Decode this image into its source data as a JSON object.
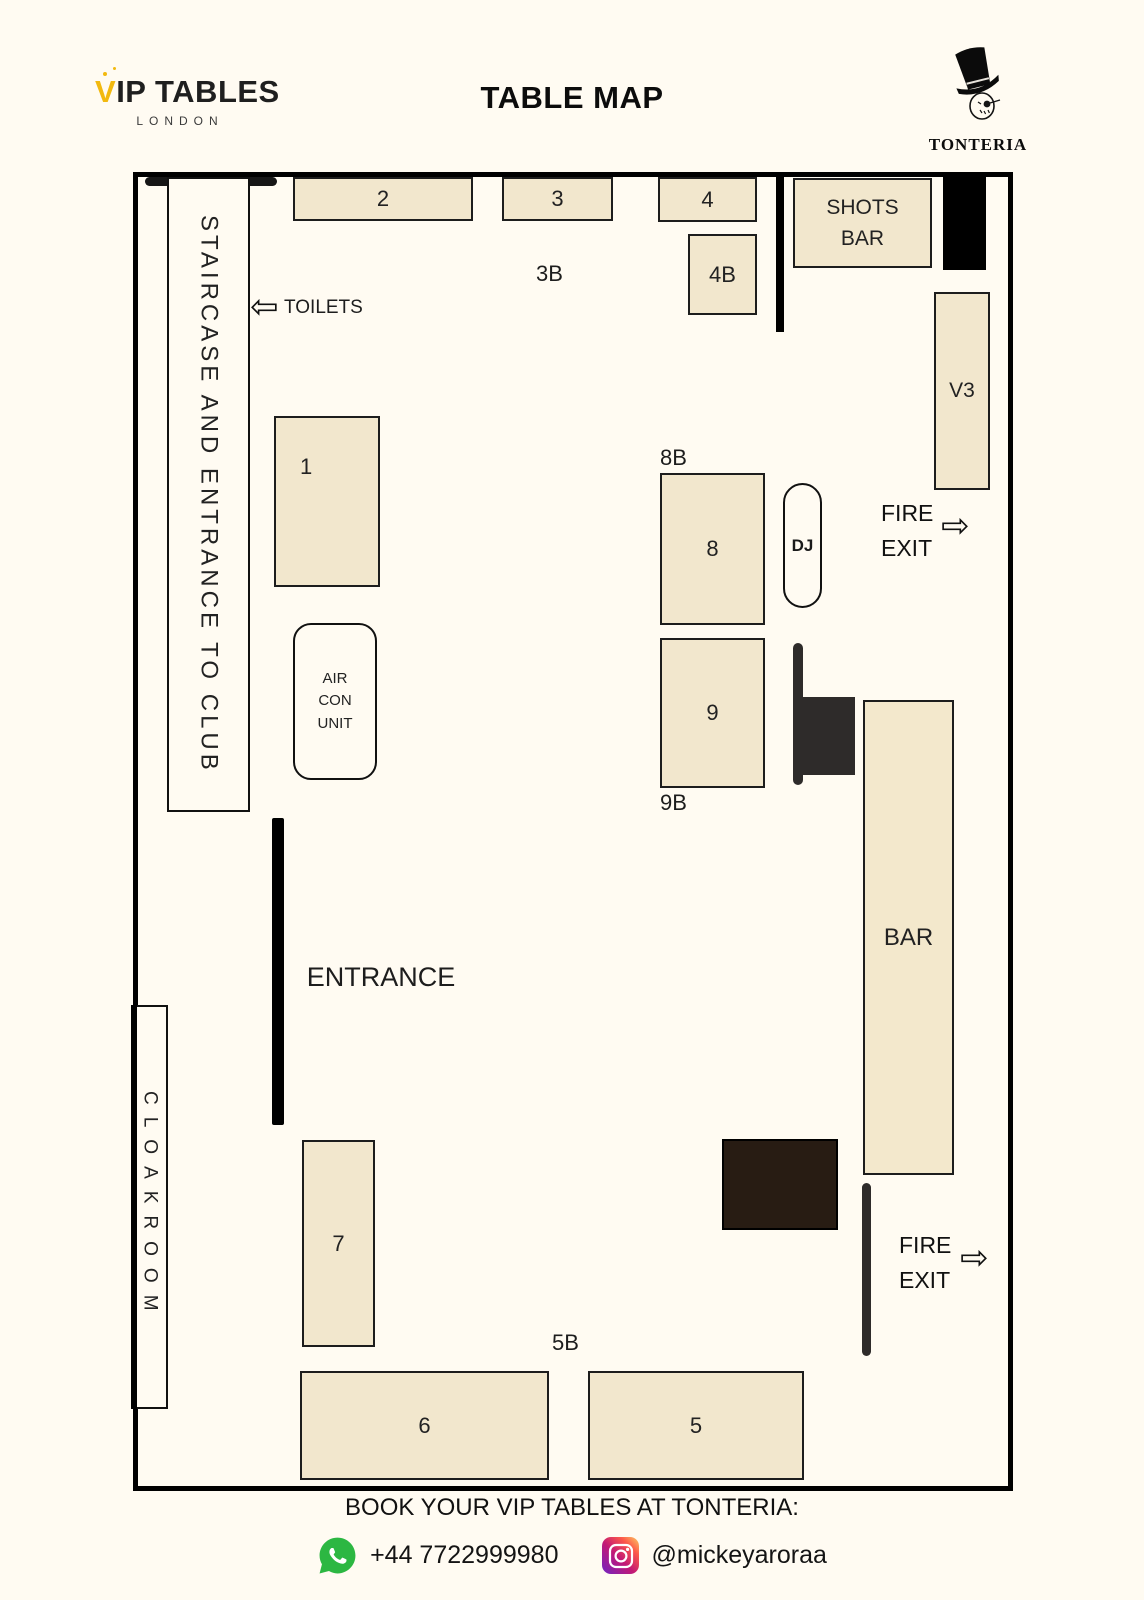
{
  "header": {
    "brand": {
      "name": "VIP TABLES",
      "city": "LONDON"
    },
    "title": "TABLE MAP",
    "venue": "TONTERIA"
  },
  "map": {
    "staircase_label": "STAIRCASE AND ENTRANCE TO CLUB",
    "toilets_label": "TOILETS",
    "entrance_label": "ENTRANCE",
    "cloakroom_label": "CLOAKROOM",
    "shots_bar": {
      "line1": "SHOTS",
      "line2": "BAR"
    },
    "bar_label": "BAR",
    "dj_label": "DJ",
    "aircon": {
      "line1": "AIR",
      "line2": "CON",
      "line3": "UNIT"
    },
    "fire_exit": {
      "line1": "FIRE",
      "line2": "EXIT"
    },
    "tables": {
      "t1": "1",
      "t2": "2",
      "t3": "3",
      "t4": "4",
      "t4b": "4B",
      "t5": "5",
      "t6": "6",
      "t7": "7",
      "t8": "8",
      "t9": "9",
      "v3": "V3"
    },
    "booths": {
      "b3": "3B",
      "b5": "5B",
      "b8": "8B",
      "b9": "9B"
    }
  },
  "icons": {
    "toilets_arrow": "⇦",
    "fire_exit_arrow": "⇨",
    "whatsapp": "whatsapp-icon",
    "instagram": "instagram-icon"
  },
  "footer": {
    "cta": "BOOK YOUR VIP TABLES AT TONTERIA:",
    "phone": "+44 7722999980",
    "instagram_handle": "@mickeyaroraa"
  },
  "colors": {
    "background": "#FFFBF2",
    "table_fill": "#F2E7CD",
    "outline": "#000000",
    "accent_yellow": "#F2B90F",
    "whatsapp_green": "#2CB742",
    "instagram_gradient": [
      "#7024C4",
      "#C21975",
      "#FD5949",
      "#FCCC63"
    ],
    "dark_block": "#2E2B2A",
    "dark_brown_block": "#281C13"
  }
}
